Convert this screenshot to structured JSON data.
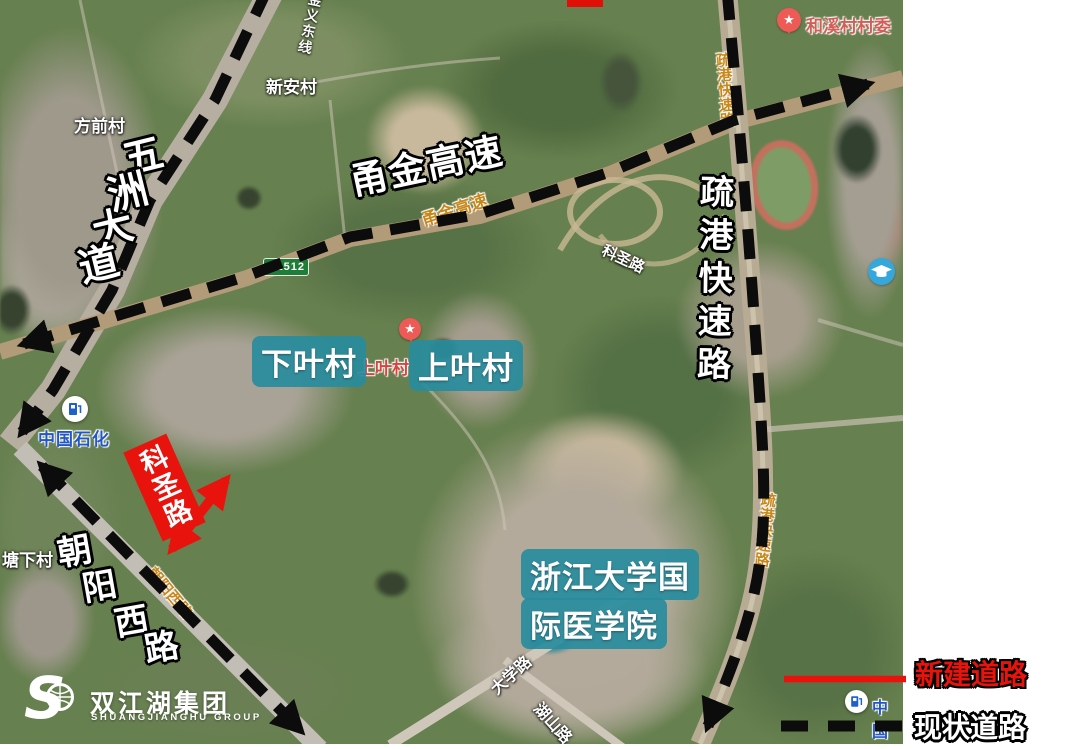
{
  "map": {
    "annotations": {
      "wuzhou_avenue": "五洲大道",
      "yongjin_expressway": "甬金高速",
      "shugang_expressway": "疏港快速路",
      "chaoyang_west_road": "朝阳西路",
      "kesheng_road": "科圣路",
      "xiaye_village": "下叶村",
      "shangye_village": "上叶村",
      "zju_medical_line1": "浙江大学国",
      "zju_medical_line2": "际医学院"
    },
    "base_labels": {
      "fangqian_village": "方前村",
      "xinan_village": "新安村",
      "rail_line": "金义东线",
      "hexi_village_committee": "和溪村村委",
      "tangxia_village": "塘下村",
      "shangye_village_poi": "上叶村",
      "kesheng_road_small": "科圣路",
      "daxue_road": "大学路",
      "hushan_road": "湖山路",
      "sinopec": "中国石化",
      "sinopec_partial": "中国",
      "g1512_shield": "G1512",
      "yongjin_road_name": "甬金高速",
      "shugang_road_name_north": "疏港快速路",
      "shugang_road_name_south": "疏港快速路",
      "chaoyang_road_name": "朝阳西路"
    },
    "icons": {
      "star_pin": "★"
    }
  },
  "legend": {
    "new_road_label": "新建道路",
    "new_road_color": "#e8130c",
    "existing_road_label": "现状道路",
    "existing_road_color": "#111111"
  },
  "logo": {
    "initial": "S",
    "name_cn": "双江湖集团",
    "name_en": "SHUANGJIANGHU GROUP"
  }
}
